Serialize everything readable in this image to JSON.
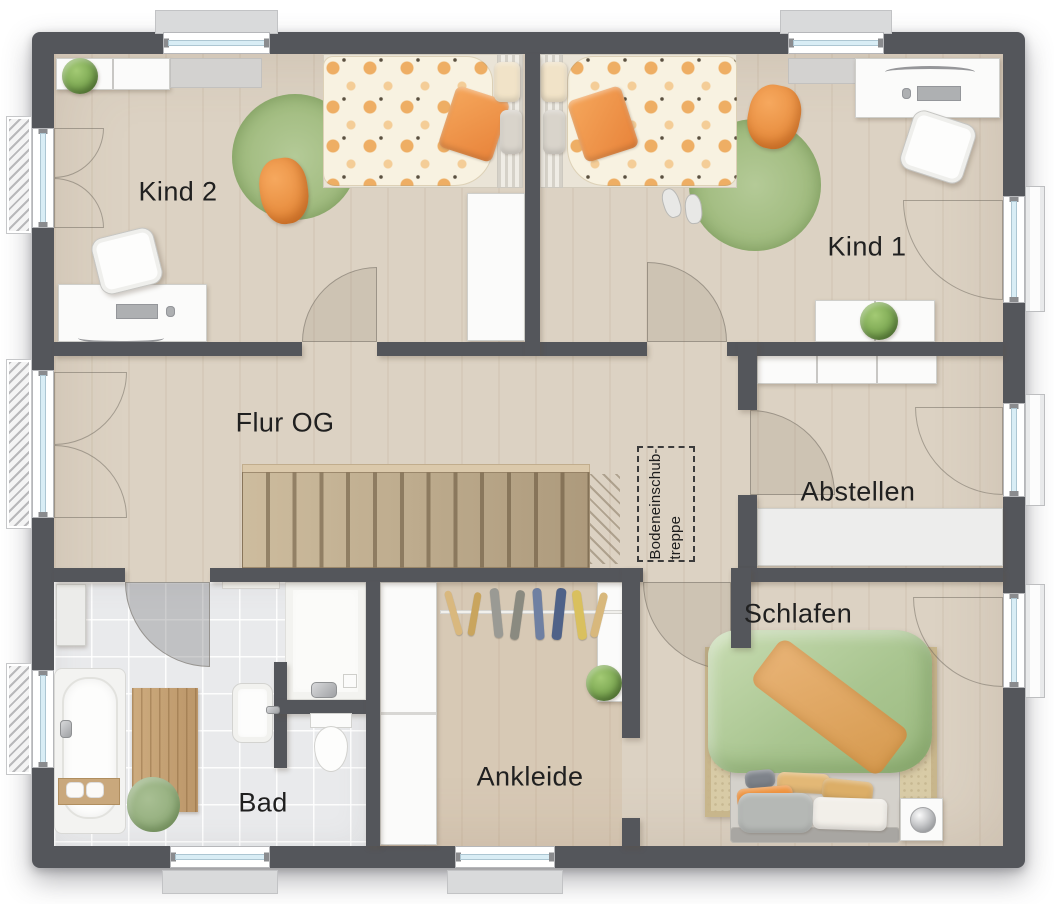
{
  "rooms": {
    "kind2": {
      "label": "Kind 2"
    },
    "kind1": {
      "label": "Kind 1"
    },
    "flur": {
      "label": "Flur OG"
    },
    "abstellen": {
      "label": "Abstellen"
    },
    "schlafen": {
      "label": "Schlafen"
    },
    "ankleide": {
      "label": "Ankleide"
    },
    "bad": {
      "label": "Bad"
    }
  },
  "annotations": {
    "attic_hatch": {
      "label": "Bodeneinschub-\ntreppe"
    }
  },
  "colors": {
    "wall": "#54565b",
    "floor_wood": "#dcd2c3",
    "floor_tile": "#e9eaec",
    "stairs_wood": "#c2ae8e",
    "rug_green": "#a3bd82",
    "duvet_green": "#aec892",
    "accent_orange": "#ee943e",
    "throw_orange": "#d9a05a",
    "window_glass": "#d9edf5"
  }
}
